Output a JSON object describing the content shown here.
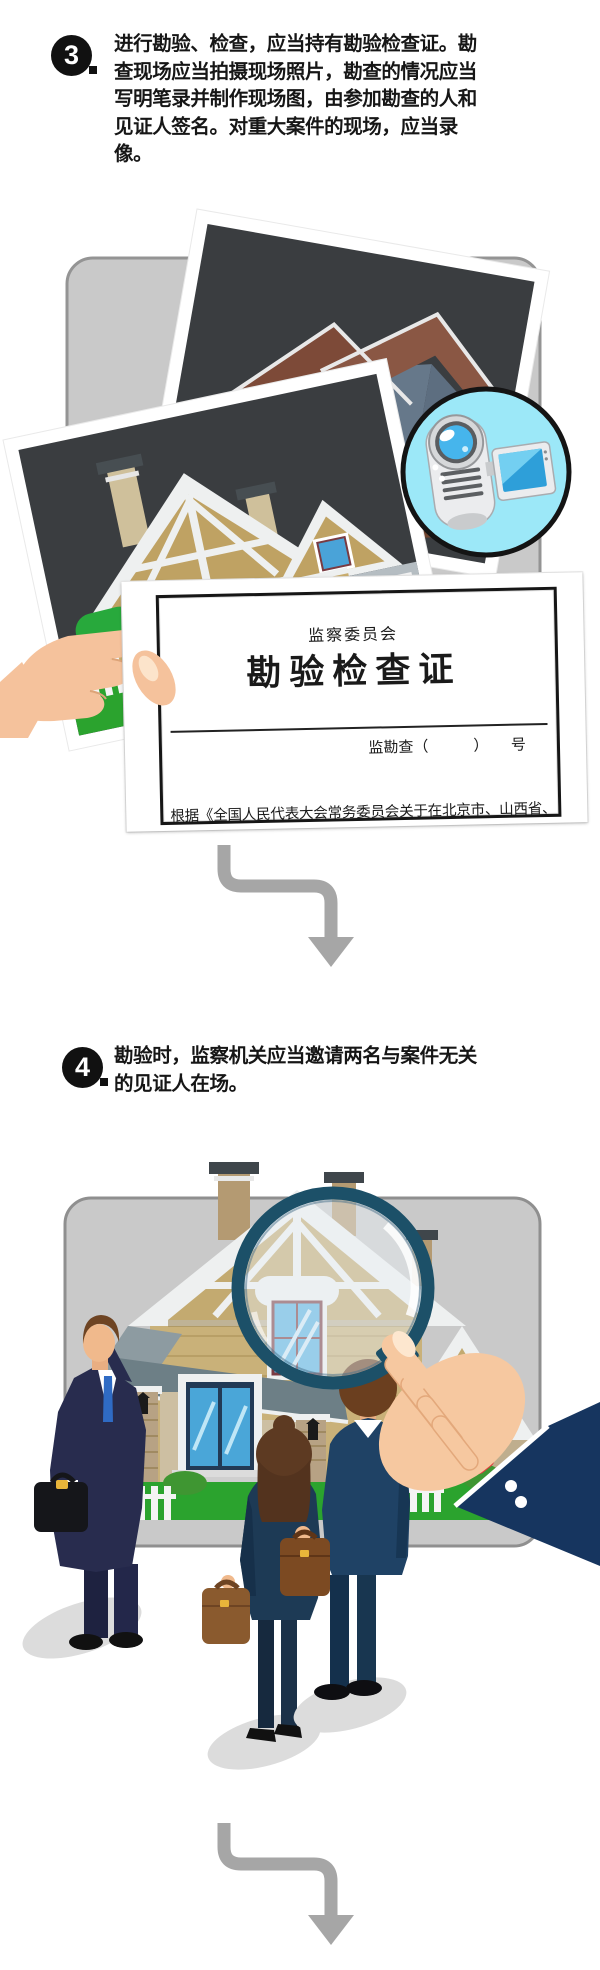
{
  "colors": {
    "badge_bg": "#111111",
    "badge_text": "#ffffff",
    "body_text": "#161616",
    "arrow_gray": "#a6a6a6",
    "panel_fill": "#c9c9c9",
    "panel_border": "#949494",
    "photo_bg": "#3a3d40",
    "camera_badge_bg": "#9ce8f8",
    "lawn_green": "#2ba32e",
    "magnifier_rim": "#1c5068",
    "magnifier_handle": "#e23b3f",
    "sleeve_navy": "#16355f",
    "suit_navy": "#282c4e",
    "skin": "#f5c29c",
    "cert_paper": "#ffffff",
    "cert_border": "#161616"
  },
  "step3": {
    "label": "3.",
    "digit": "3",
    "lines": [
      "进行勘验、检查，应当持有勘验检查证。勘",
      "查现场应当拍摄现场照片，勘查的情况应当",
      "写明笔录并制作现场图，由参加勘查的人和",
      "见证人签名。对重大案件的现场，应当录像。"
    ]
  },
  "step4": {
    "label": "4.",
    "digit": "4",
    "lines": [
      "勘验时，监察机关应当邀请两名与案件无关",
      "的见证人在场。"
    ]
  },
  "certificate": {
    "issuer": "监察委员会",
    "title": "勘验检查证",
    "serial_line": "监勘查（　　　）　　号",
    "body_text": "根据《全国人民代表大会常务委员会关于在北京市、山西省、"
  },
  "icons": {
    "video_camera": "video-camera-icon",
    "magnifying_glass": "magnifying-glass-icon",
    "flow_arrow": "curved-down-arrow-icon"
  }
}
